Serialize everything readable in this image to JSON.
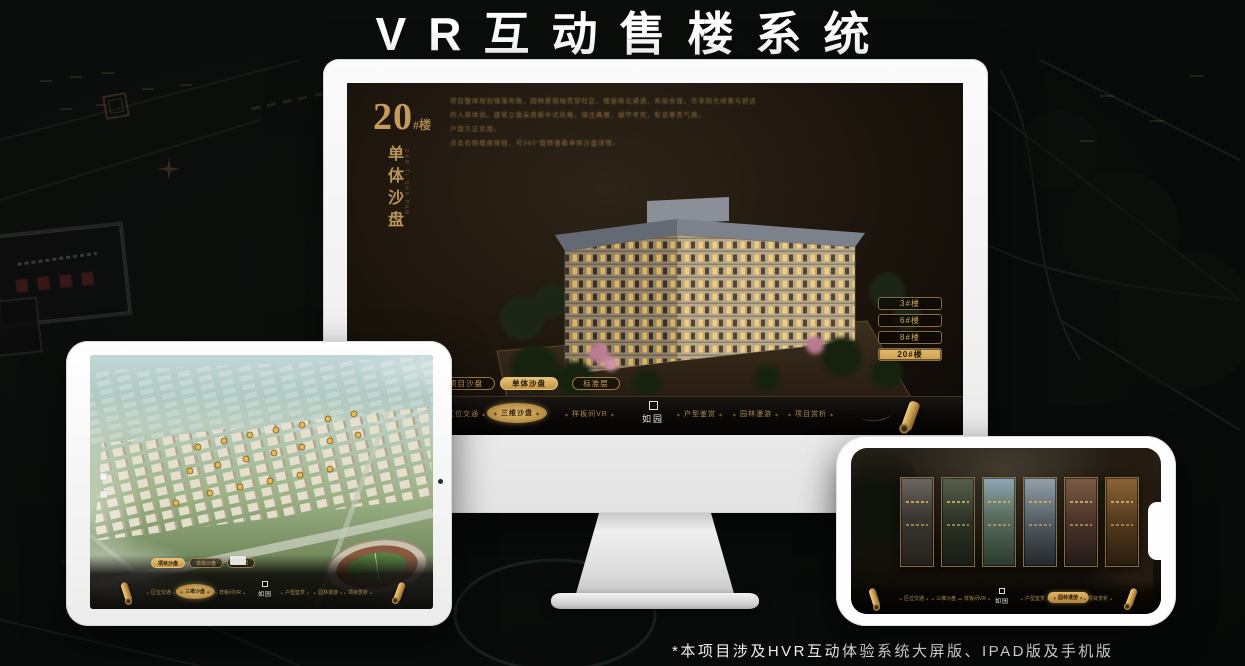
{
  "page": {
    "title": "VR互动售楼系统",
    "footnote": "*本项目涉及HVR互动体验系统大屏版、IPAD版及手机版"
  },
  "colors": {
    "gold": "#c9a262",
    "gold_deep": "#8a6f45",
    "active_gold": "#d9b061",
    "screen_brown": "#1b1510"
  },
  "monitor": {
    "building_no": "20",
    "building_no_suffix": "#楼",
    "subtitle": "单体沙盘",
    "subtitle_en": "DAN TI SHA PAN",
    "description": {
      "line1": "项目整体规划错落有致，园林景观轴贯穿社区，楼座南北通透、布局合理，尽享阳光绿意与舒适",
      "line2": "的人居体验。建筑立面采用新中式风格，端庄典雅、细节考究，彰显尊贵气质。",
      "line3": "户型方正实用。",
      "line4": "点击右侧楼座按钮，可360°旋转查看单体沙盘详情。"
    },
    "floor_buttons": [
      {
        "label": "3#楼",
        "active": false
      },
      {
        "label": "6#楼",
        "active": false
      },
      {
        "label": "8#楼",
        "active": false
      },
      {
        "label": "20#楼",
        "active": true
      }
    ],
    "mode_buttons": [
      {
        "label": "项目沙盘",
        "active": false
      },
      {
        "label": "单体沙盘",
        "active": true
      },
      {
        "label": "标准层",
        "active": false
      }
    ],
    "nav": {
      "logo": "如园",
      "items": [
        {
          "label": "区位交通",
          "active": false
        },
        {
          "label": "三维沙盘",
          "active": true
        },
        {
          "label": "样板间VR",
          "active": false
        },
        {
          "label": "户型鉴赏",
          "active": false
        },
        {
          "label": "园林漫游",
          "active": false
        },
        {
          "label": "项目赏析",
          "active": false
        }
      ]
    }
  },
  "ipad": {
    "mode_buttons": [
      {
        "label": "项目沙盘",
        "active": true
      },
      {
        "label": "单体沙盘",
        "active": false
      },
      {
        "label": "标准层",
        "active": false
      }
    ],
    "nav": {
      "logo": "如园",
      "items": [
        {
          "label": "区位交通",
          "active": false
        },
        {
          "label": "三维沙盘",
          "active": true
        },
        {
          "label": "样板间VR",
          "active": false
        },
        {
          "label": "户型鉴赏",
          "active": false
        },
        {
          "label": "园林漫游",
          "active": false
        },
        {
          "label": "项目赏析",
          "active": false
        }
      ]
    }
  },
  "phone": {
    "nav": {
      "logo": "如园",
      "items": [
        {
          "label": "区位交通",
          "active": false
        },
        {
          "label": "三维沙盘",
          "active": false
        },
        {
          "label": "样板间VR",
          "active": false
        },
        {
          "label": "户型鉴赏",
          "active": false
        },
        {
          "label": "园林漫游",
          "active": true
        },
        {
          "label": "项目赏析",
          "active": false
        }
      ]
    }
  }
}
